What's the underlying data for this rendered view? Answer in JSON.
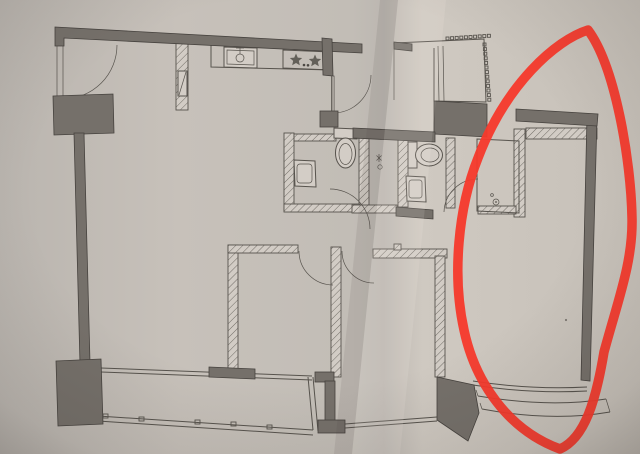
{
  "scene": {
    "kind": "photo-of-floor-plan",
    "description": "Photograph of a printed apartment floor plan; a hand-drawn red marker ellipse circles the room on the right side of the plan. No text labels are visible."
  },
  "colors": {
    "paper": "#c7c1ba",
    "paper_left": "#bab5af",
    "paper_right": "#cfc9c1",
    "line": "#57534d",
    "wall_fill": "#75706a",
    "wall_edge": "#46423e",
    "hatch_fill": "#d2ccc5",
    "fixture_fill": "#d3cdc6",
    "annotation_red": "#f5392b"
  },
  "plan": {
    "rooms": [
      "entry",
      "living-dining",
      "kitchen",
      "bathroom-1",
      "bathroom-2",
      "bedroom-1",
      "bedroom-2",
      "circled-room",
      "closet",
      "balcony",
      "utility-platform"
    ],
    "fixtures": [
      "entry-door",
      "kitchen-sink",
      "gas-stove-2-burner",
      "toilet-1",
      "washbasin-1",
      "shower-floor-drain",
      "toilet-2",
      "washbasin-2",
      "closet-floor-drain",
      "balcony-window",
      "bay-window-bedroom-2",
      "bay-window-circled-room",
      "louver-grille"
    ]
  },
  "annotation": {
    "tool": "marker",
    "shape": "hand-drawn-ellipse",
    "color": "#f5392b",
    "encircles": "right-side room of the plan"
  }
}
